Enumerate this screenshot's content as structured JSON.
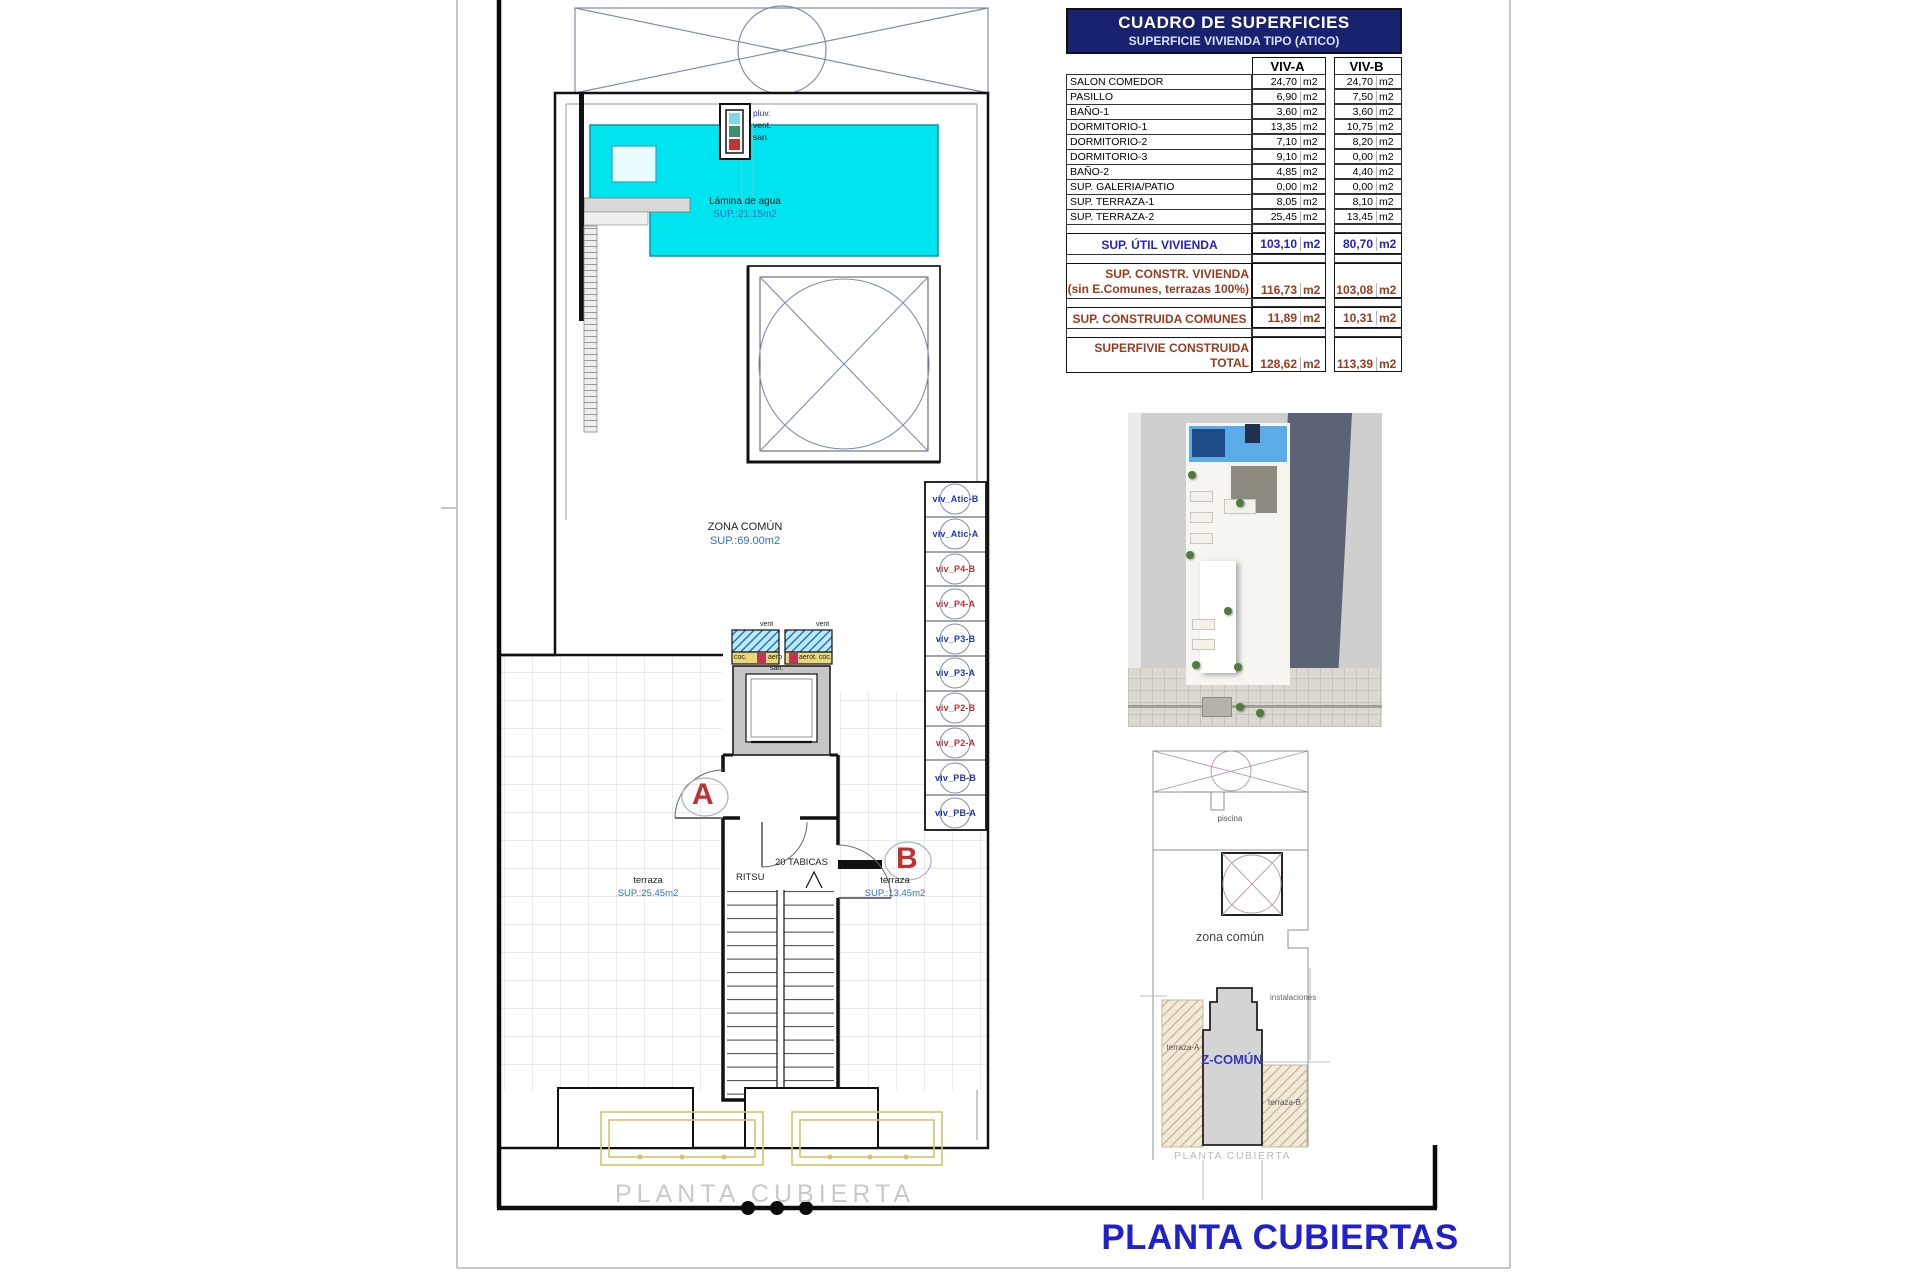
{
  "sheet": {
    "title": "PLANTA CUBIERTAS"
  },
  "surface_table": {
    "title": "CUADRO DE SUPERFICIES",
    "subtitle": "SUPERFICIE VIVIENDA TIPO (ATICO)",
    "columns": [
      "VIV-A",
      "VIV-B"
    ],
    "unit": "m2",
    "rows": [
      {
        "label": "SALON COMEDOR",
        "a": "24,70",
        "b": "24,70"
      },
      {
        "label": "PASILLO",
        "a": "6,90",
        "b": "7,50"
      },
      {
        "label": "BAÑO-1",
        "a": "3,60",
        "b": "3,60"
      },
      {
        "label": "DORMITORIO-1",
        "a": "13,35",
        "b": "10,75"
      },
      {
        "label": "DORMITORIO-2",
        "a": "7,10",
        "b": "8,20"
      },
      {
        "label": "DORMITORIO-3",
        "a": "9,10",
        "b": "0,00"
      },
      {
        "label": "BAÑO-2",
        "a": "4,85",
        "b": "4,40"
      },
      {
        "label": "SUP. GALERIA/PATIO",
        "a": "0,00",
        "b": "0,00"
      },
      {
        "label": "SUP. TERRAZA-1",
        "a": "8,05",
        "b": "8,10"
      },
      {
        "label": "SUP. TERRAZA-2",
        "a": "25,45",
        "b": "13,45"
      }
    ],
    "summary_util": {
      "label": "SUP. ÚTIL VIVIENDA",
      "a": "103,10",
      "b": "80,70"
    },
    "summary_constr": {
      "label_line1": "SUP. CONSTR. VIVIENDA",
      "label_line2": "(sin E.Comunes, terrazas 100%)",
      "a": "116,73",
      "b": "103,08"
    },
    "summary_comunes": {
      "label": "SUP. CONSTRUIDA COMUNES",
      "a": "11,89",
      "b": "10,31"
    },
    "summary_total": {
      "label_line1": "SUPERFIVIE CONSTRUIDA",
      "label_line2": "TOTAL",
      "a": "128,62",
      "b": "113,39"
    }
  },
  "floor_plan": {
    "watermark": "PLANTA CUBIERTA",
    "pool_label": "Lámina de agua",
    "pool_area": "SUP.:21.15m2",
    "zona_comun_label": "ZONA COMÚN",
    "zona_comun_area": "SUP.:69.00m2",
    "terraza_left_label": "terraza",
    "terraza_left_area": "SUP.:25.45m2",
    "terraza_right_label": "terraza",
    "terraza_right_area": "SUP.:13.45m2",
    "stair_label": "RITSU",
    "tabicas_label": "20 TABICAS",
    "door_a": "A",
    "door_b": "B",
    "riser_legend": [
      "pluv.",
      "vent.",
      "san."
    ],
    "shaft_legend": {
      "vent_left": "vent",
      "vent_right": "vent",
      "coc": "coc.",
      "aero": "aero",
      "aerot_coc": "aerot. coc.",
      "san": "san."
    },
    "risers": [
      {
        "label": "viv_Atic-B",
        "color": "blue"
      },
      {
        "label": "viv_Atic-A",
        "color": "blue"
      },
      {
        "label": "viv_P4-B",
        "color": "red"
      },
      {
        "label": "viv_P4-A",
        "color": "red"
      },
      {
        "label": "viv_P3-B",
        "color": "blue"
      },
      {
        "label": "viv_P3-A",
        "color": "blue"
      },
      {
        "label": "viv_P2-B",
        "color": "red"
      },
      {
        "label": "viv_P2-A",
        "color": "red"
      },
      {
        "label": "viv_PB-B",
        "color": "blue"
      },
      {
        "label": "viv_PB-A",
        "color": "blue"
      }
    ]
  },
  "site_plan": {
    "piscina_label": "piscina",
    "zona_comun_label": "zona común",
    "instalaciones_label": "instalaciones",
    "terraza_a_label": "terraza-A",
    "z_comun_label": "Z-COMÚN",
    "terraza_b_label": "terraza-B",
    "caption": "PLANTA CUBIERTA"
  },
  "colors": {
    "pool_cyan": "#00e4f0",
    "table_header_navy": "#19226e",
    "value_blue": "#2222cc",
    "value_brown": "#9c3a1e",
    "title_blue": "#2121cb",
    "riser_blue": "#2233bb",
    "riser_red": "#c03030",
    "door_letter_red": "#c03030",
    "area_label_blue": "#2f6fc4",
    "awning_yellow": "#d6c26a"
  }
}
